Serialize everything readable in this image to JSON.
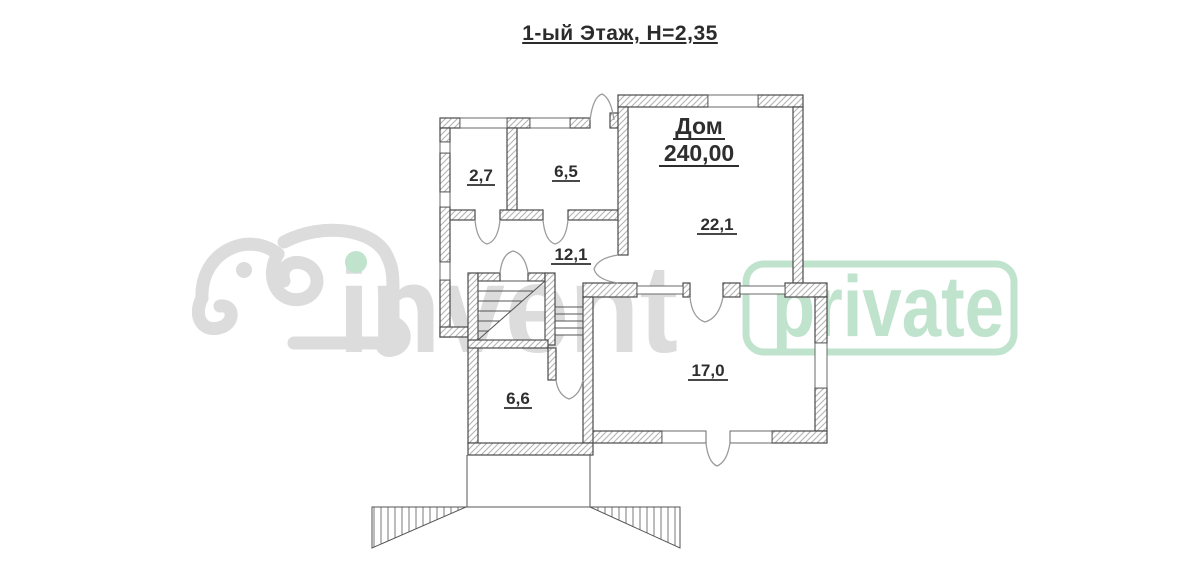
{
  "page": {
    "title": "1-ый Этаж, Н=2,35"
  },
  "plan": {
    "house": {
      "name": "Дом",
      "total_area": "240,00"
    },
    "rooms": [
      {
        "name": "room-2-7",
        "area": "2,7"
      },
      {
        "name": "room-6-5",
        "area": "6,5"
      },
      {
        "name": "room-12-1",
        "area": "12,1"
      },
      {
        "name": "room-22-1",
        "area": "22,1"
      },
      {
        "name": "room-6-6",
        "area": "6,6"
      },
      {
        "name": "room-17-0",
        "area": "17,0"
      }
    ]
  },
  "watermarks": {
    "left_brand": "invent",
    "right_brand": "private"
  },
  "colors": {
    "watermark_gray": "#dcdcdc",
    "watermark_green": "#bfe3cd",
    "wall_line": "#4a4a4a",
    "hatch_line": "#b3b3b3",
    "label_text": "#2e2e2e"
  }
}
